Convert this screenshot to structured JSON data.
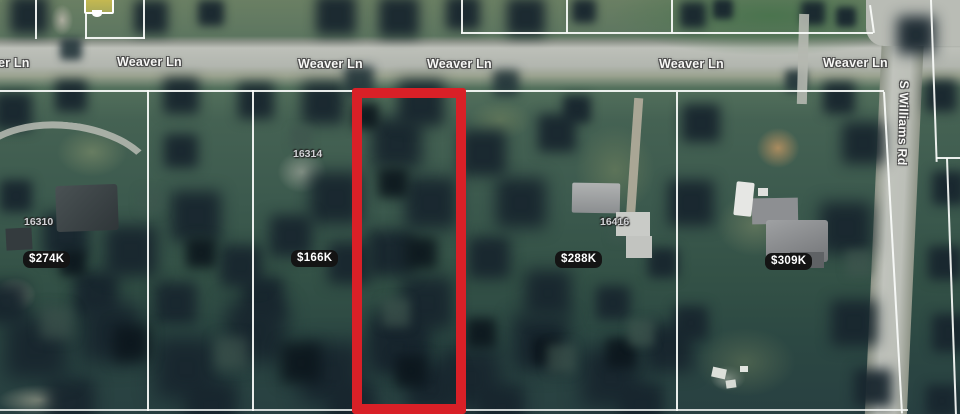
{
  "view": {
    "type": "satellite-map",
    "streets": {
      "weaver": [
        "er Ln",
        "Weaver Ln",
        "Weaver Ln",
        "Weaver Ln",
        "Weaver Ln",
        "Weaver Ln"
      ],
      "williams": "S Williams Rd"
    },
    "parcel_numbers": [
      "16310",
      "16314",
      "16416"
    ],
    "price_badges": [
      "$274K",
      "$166K",
      "$288K",
      "$309K"
    ],
    "colors": {
      "highlight_outline": "#d92027",
      "boundary_line": "#fafcfa",
      "road": "#b6b9b2",
      "badge_bg": "#141414",
      "badge_text": "#ffffff"
    }
  }
}
